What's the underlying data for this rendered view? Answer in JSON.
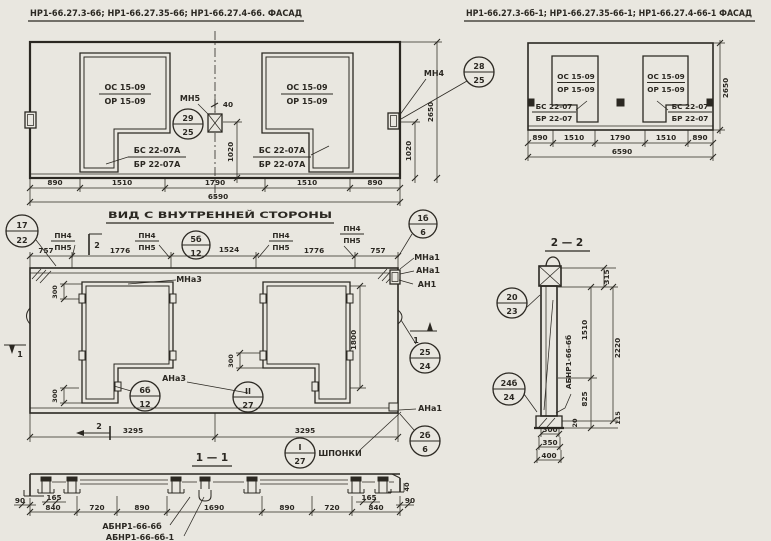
{
  "sheet": {
    "background": "#e9e7e0",
    "ink_color": "#2b2822"
  },
  "facade_main": {
    "title": "НР1-66.27.3-66; НР1-66.27.35-66; НР1-66.27.4-66. ФАСАД",
    "opening_label_top": "ОС 15-09",
    "opening_label_bot": "ОР 15-09",
    "sill_label_top": "БС 22-07А",
    "sill_label_bot": "БР 22-07А",
    "anchor_mid_label": "МН5",
    "anchor_right_label": "МН4",
    "callout_mid": {
      "num": "29",
      "sheet": "25"
    },
    "callout_right": {
      "num": "28",
      "sheet": "25"
    },
    "dim_40": "40",
    "dim_1020_mid": "1020",
    "dim_1020_right": "1020",
    "dim_height": "2650",
    "dims_bottom": [
      "890",
      "1510",
      "1790",
      "1510",
      "890"
    ],
    "dim_total": "6590"
  },
  "facade_mirror": {
    "title": "НР1-66.27.3-6б-1; НР1-66.27.35-66-1; НР1-66.27.4-66-1 ФАСАД",
    "opening_label_top": "ОС 15-09",
    "opening_label_bot": "ОР 15-09",
    "sill_label_top": "БС 22-07",
    "sill_label_bot": "БР 22-07",
    "dim_height": "2650",
    "dims_bottom": [
      "890",
      "1510",
      "1790",
      "1510",
      "890"
    ],
    "dim_total": "6590"
  },
  "inner_view": {
    "title": "ВИД С ВНУТРЕННЕЙ СТОРОНЫ",
    "dims_top": [
      "757",
      "1776",
      "1524",
      "1776",
      "757"
    ],
    "rail_label_top": "ПН4",
    "rail_label_bot": "ПН5",
    "label_mna3": "МНа3",
    "label_ana3": "АНа3",
    "label_mna1": "МНа1",
    "label_ana1": "АНа1",
    "label_an1": "АН1",
    "label_ana1_bottom": "АНа1",
    "label_shponki": "ШПОНКИ",
    "dim_300": "300",
    "dim_1800": "1800",
    "dim_3295_left": "3295",
    "dim_3295_right": "3295",
    "marker_1": "1",
    "marker_2": "2",
    "callout_17_22": {
      "num": "17",
      "sheet": "22"
    },
    "callout_5b_12": {
      "num": "5б",
      "sheet": "12"
    },
    "callout_1b_6": {
      "num": "1б",
      "sheet": "6"
    },
    "callout_6b_12": {
      "num": "6б",
      "sheet": "12"
    },
    "callout_2_27": {
      "num": "II",
      "sheet": "27"
    },
    "callout_25_24": {
      "num": "25",
      "sheet": "24"
    },
    "callout_2b_6": {
      "num": "2б",
      "sheet": "6"
    },
    "callout_1_27": {
      "num": "I",
      "sheet": "27"
    }
  },
  "section_2_2": {
    "title": "2 — 2",
    "part_label": "АБНР1-66-6б",
    "dim_315": "315",
    "dim_1510": "1510",
    "dim_2220": "2220",
    "dim_825": "825",
    "dim_20": "20",
    "dim_115": "115",
    "dim_300": "300",
    "dim_350": "350",
    "dim_400": "400",
    "callout_20_23": {
      "num": "20",
      "sheet": "23"
    },
    "callout_24b_24": {
      "num": "24б",
      "sheet": "24"
    }
  },
  "section_1_1": {
    "title": "1 — 1",
    "dims_main": [
      "840",
      "720",
      "890",
      "1690",
      "890",
      "720",
      "840"
    ],
    "dim_90_left": "90",
    "dim_90_right": "90",
    "dim_165_left": "165",
    "dim_165_right": "165",
    "dim_40": "40",
    "part_label_1": "АБНР1-66-6б",
    "part_label_2": "АБНР1-66-6б-1"
  }
}
